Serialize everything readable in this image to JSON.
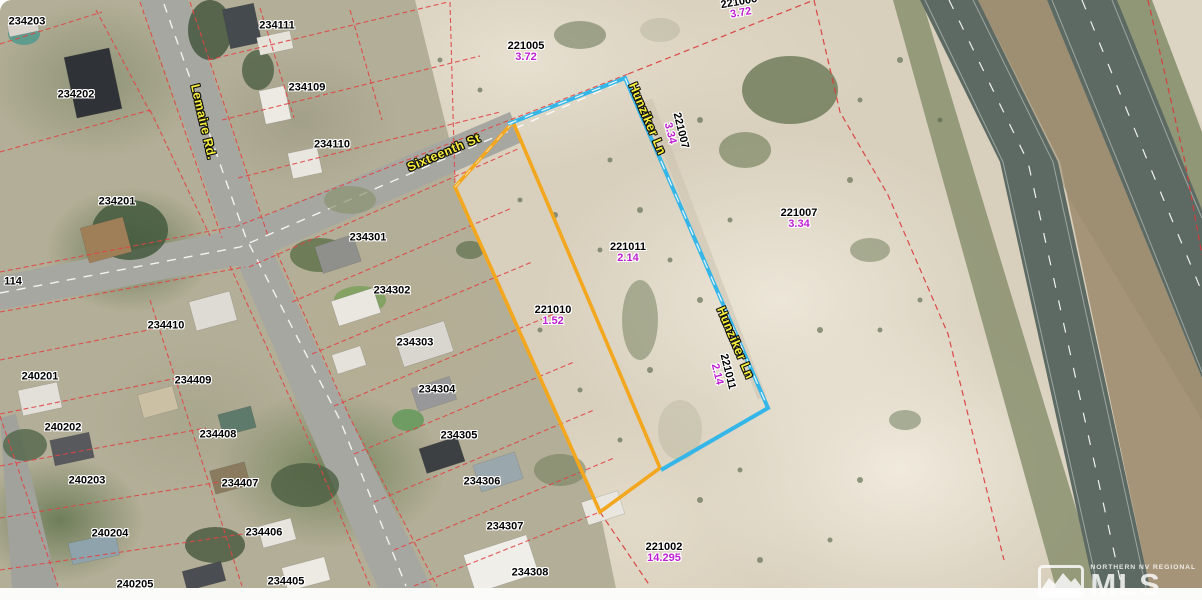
{
  "map_type": "parcel-aerial-map",
  "watermark": {
    "region": "NORTHERN NV REGIONAL",
    "brand": "MLS"
  },
  "streets": [
    {
      "name": "Lemaire Rd."
    },
    {
      "name": "Sixteenth St"
    },
    {
      "name": "Hunziker Ln"
    },
    {
      "name": "Hunziker Ln"
    }
  ],
  "parcels": [
    {
      "apn": "234203"
    },
    {
      "apn": "234111"
    },
    {
      "apn": "234202"
    },
    {
      "apn": "234109"
    },
    {
      "apn": "234110"
    },
    {
      "apn": "234201"
    },
    {
      "apn": "114"
    },
    {
      "apn": "234301"
    },
    {
      "apn": "234302"
    },
    {
      "apn": "234303"
    },
    {
      "apn": "234304"
    },
    {
      "apn": "234305"
    },
    {
      "apn": "234306"
    },
    {
      "apn": "234307"
    },
    {
      "apn": "234308"
    },
    {
      "apn": "234410"
    },
    {
      "apn": "240201"
    },
    {
      "apn": "234409"
    },
    {
      "apn": "240202"
    },
    {
      "apn": "234408"
    },
    {
      "apn": "240203"
    },
    {
      "apn": "234407"
    },
    {
      "apn": "240204"
    },
    {
      "apn": "234406"
    },
    {
      "apn": "240205"
    },
    {
      "apn": "234405"
    }
  ],
  "acreage_parcels": [
    {
      "apn": "221005",
      "acres": "3.72"
    },
    {
      "apn": "221006",
      "acres": "3.72"
    },
    {
      "apn": "221007",
      "acres": "3.34"
    },
    {
      "apn": "221007",
      "acres": "3.34"
    },
    {
      "apn": "221011",
      "acres": "2.14"
    },
    {
      "apn": "221011",
      "acres": "2.14"
    },
    {
      "apn": "221010",
      "acres": "1.52"
    },
    {
      "apn": "221002",
      "acres": "14.295"
    }
  ],
  "colors": {
    "highlight_orange": "#f3a71f",
    "highlight_cyan": "#35b6e9",
    "parcel_line_red": "#e04545",
    "apn_text": "#000000",
    "acreage_text": "#bf1fd2",
    "street_text": "#f8ef3c",
    "desert_sand": "#d8cfbc",
    "highway_asphalt": "#5c6a63"
  }
}
